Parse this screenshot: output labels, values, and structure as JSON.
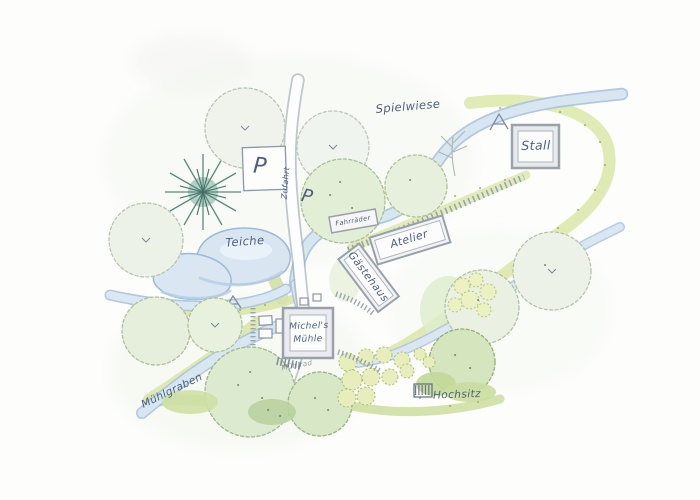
{
  "map": {
    "type": "hand-drawn watercolor site plan",
    "labels": {
      "spielwiese": "Spielwiese",
      "stall": "Stall",
      "parking_north": "P",
      "parking_south": "P",
      "zufahrt": "Zufahrt",
      "teiche": "Teiche",
      "fahrraeder": "Fahrräder",
      "atelier": "Atelier",
      "gaestehaus": "Gästehaus",
      "muehle_line1": "Michel's",
      "muehle_line2": "Mühle",
      "muehlrad": "Mühlrad",
      "muehlgraben": "Mühlgraben",
      "hochsitz": "Hochsitz"
    },
    "colors": {
      "paper": "#fdfdfc",
      "ink": "#4f617a",
      "pencil": "#8494a6",
      "water_fill": "#d8e6f2",
      "water_edge": "#a9c2db",
      "meadow": "#dce7a9",
      "meadow_dot": "#94a45e",
      "tree_pale": "#eff3ec",
      "tree_green": "#d8e8c6",
      "conifer": "#5c8a7e",
      "building_border": "#98a1ab",
      "building_fill": "#fbfcfc",
      "road_fill": "#fcfdfd"
    }
  }
}
